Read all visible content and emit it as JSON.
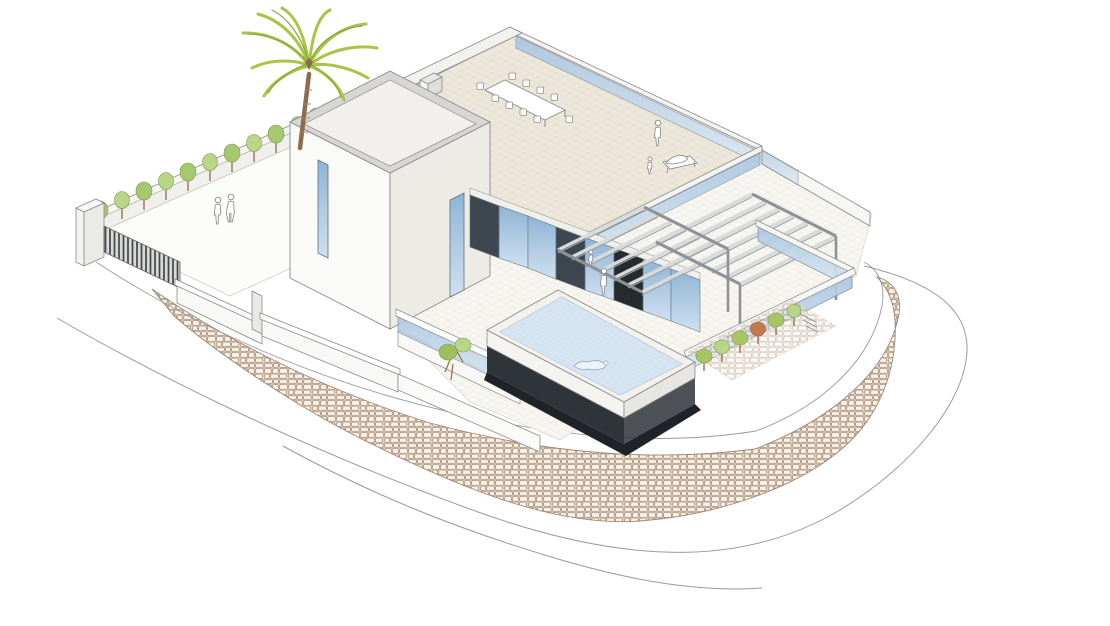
{
  "scene": {
    "title": "Modern hillside villa with elevated pool — axonometric architectural illustration",
    "medium": "architectural line rendering with soft color fills",
    "background": "#ffffff"
  },
  "palette": {
    "line": "#8a8a8a",
    "wall_white": "#fafaf8",
    "wall_shade": "#ecebe6",
    "roof_tile": "#ece8db",
    "glass_blue": "#a9c4e0",
    "glass_blue_light": "#dbe7f3",
    "pool_water": "#d8e6f2",
    "pool_base_dark": "#2f3439",
    "panel_black": "#262b30",
    "shadow_black": "#1f2327",
    "dark_panel": "#3e4750",
    "stone_fill": "#e7d9c9",
    "stone_joint": "#ad9580",
    "palm_green": "#a8c548",
    "palm_green_dark": "#86a838",
    "trunk_brown": "#8d6b4f",
    "hedge_green": "#a6c86e",
    "shrub_rust": "#c07a4c",
    "pergola_gray": "#d9dbd9"
  },
  "elements": {
    "palm_tree": "palm tree",
    "main_volume": "two-storey white volume",
    "roof_terrace": "roof terrace with outdoor dining set",
    "pergola": "slatted pergola canopy",
    "pool": "elevated infinity pool with swimmer",
    "courtyard": "entry courtyard with hedge row and louvered gate",
    "stone_wall": "curved stone retaining wall",
    "road": "perimeter road"
  },
  "figures": {
    "courtyard_people": 2,
    "roof_terrace_people": 2,
    "pool_terrace_people": 2,
    "swimmers": 1
  }
}
